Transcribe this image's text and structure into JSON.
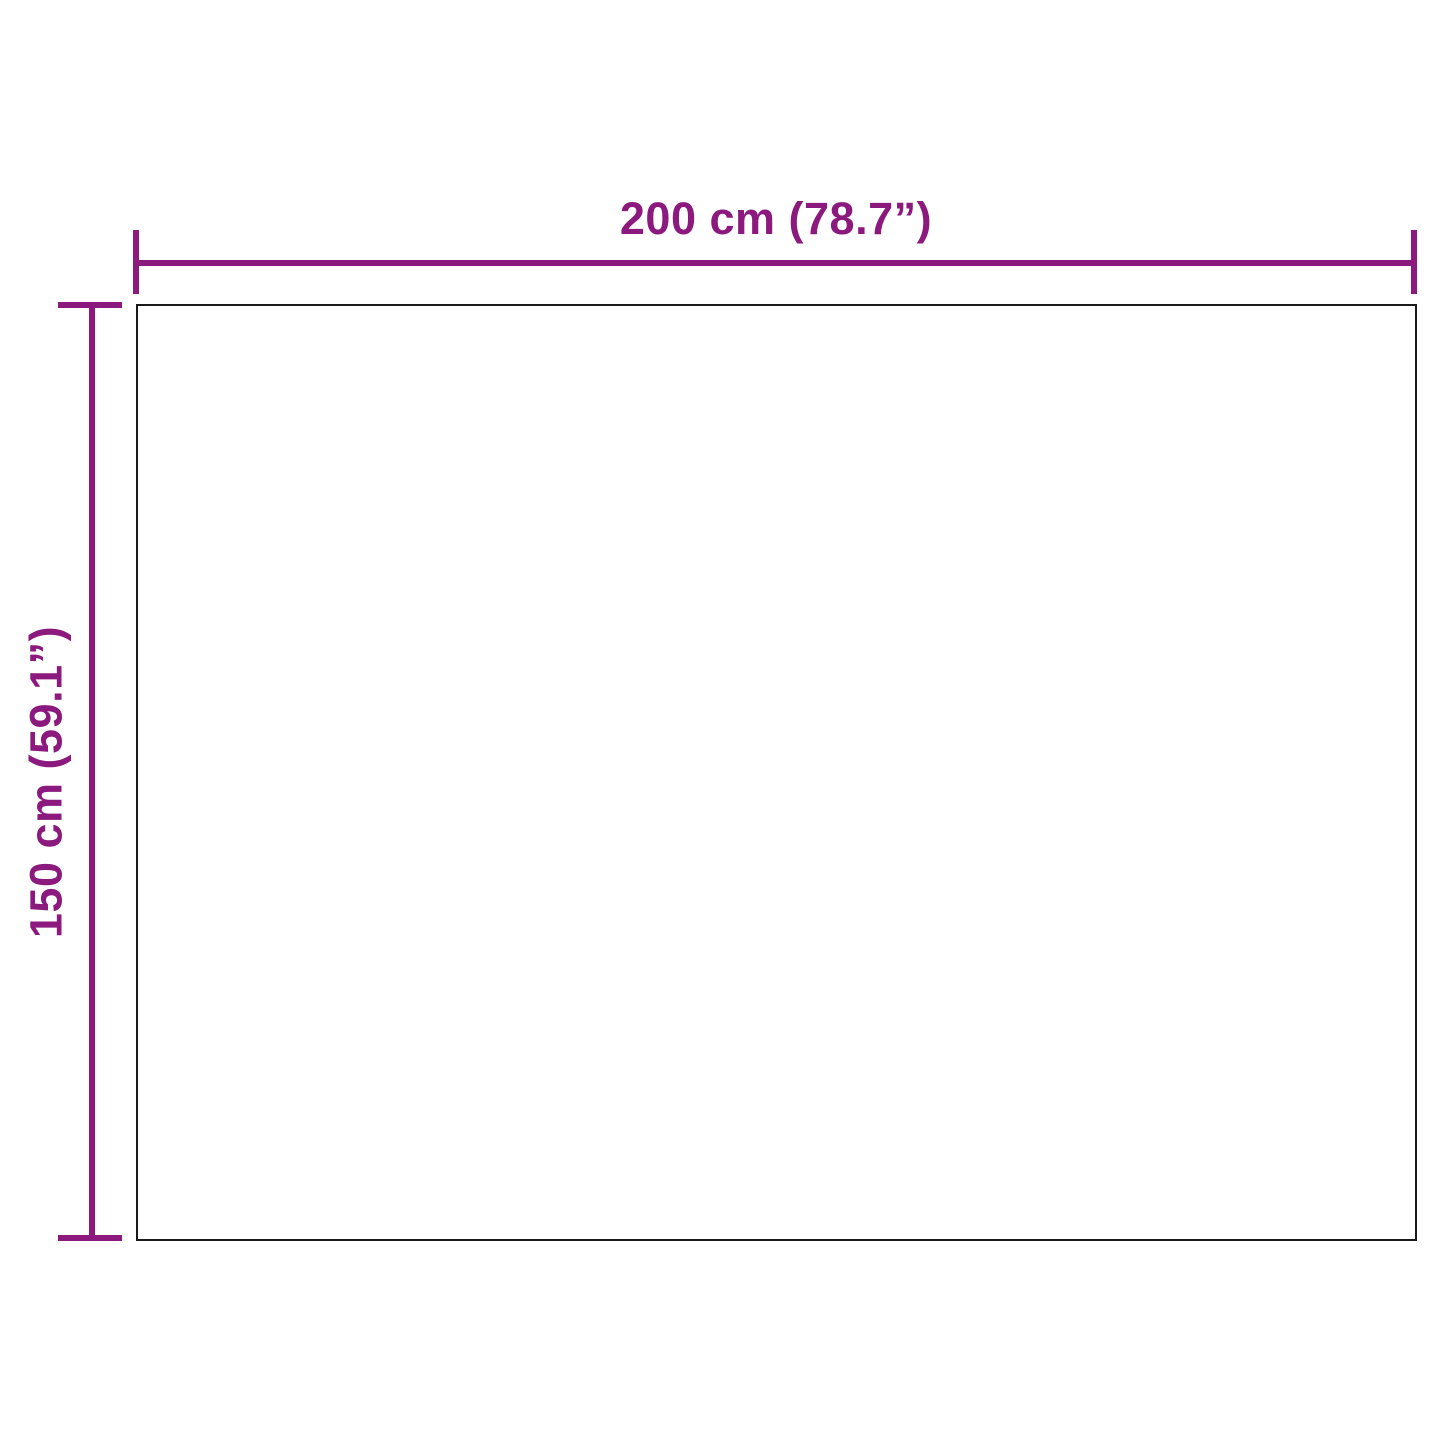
{
  "diagram": {
    "kind": "product-dimension-diagram",
    "shape": "rectangle",
    "width_label": "200 cm (78.7”)",
    "height_label": "150 cm (59.1”)",
    "width_value_cm": 200,
    "width_value_inch": 78.7,
    "height_value_cm": 150,
    "height_value_inch": 59.1
  },
  "colors": {
    "dimension_accent": "#8C197D",
    "rect_outline": "#1A1A1A",
    "background": "#FFFFFF"
  }
}
